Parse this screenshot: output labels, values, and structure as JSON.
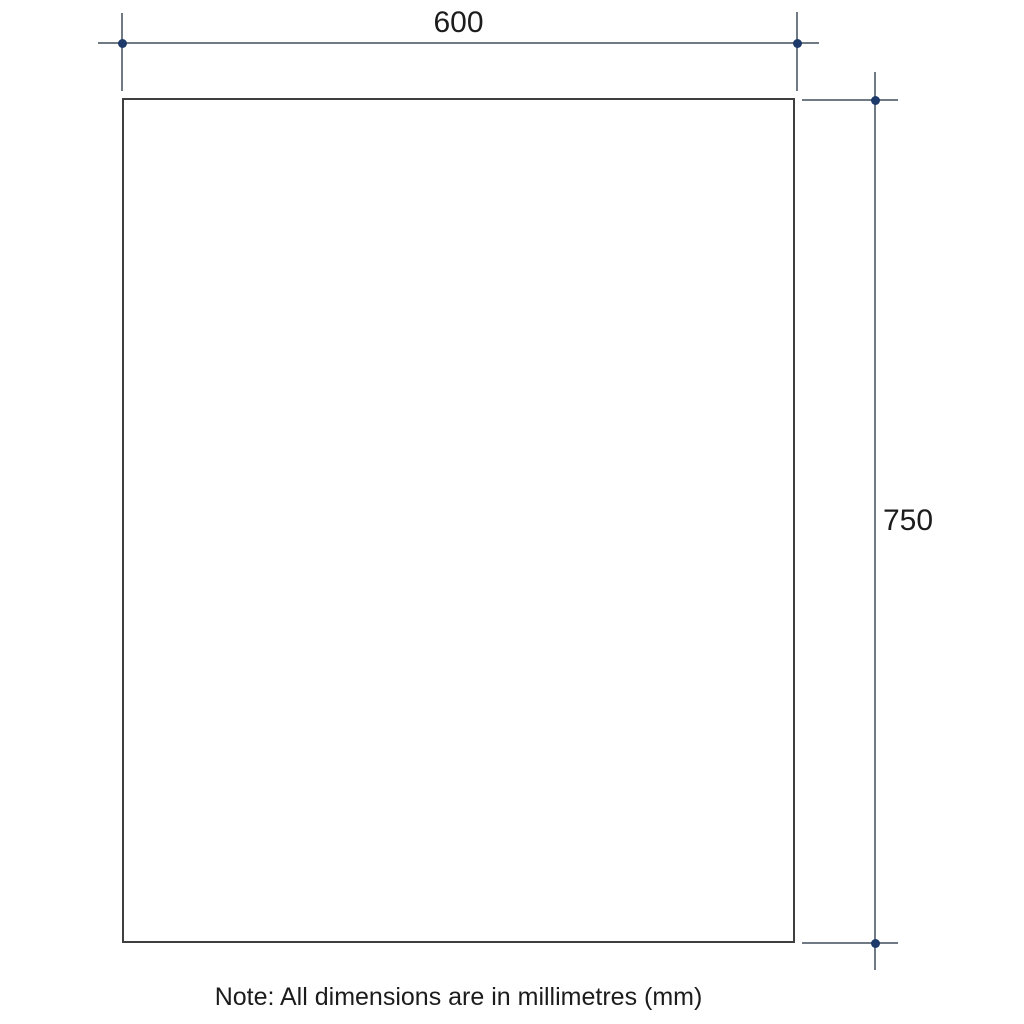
{
  "dimensions": {
    "width": {
      "value": "600"
    },
    "height": {
      "value": "750"
    }
  },
  "note": {
    "text": "Note: All dimensions are in millimetres (mm)"
  },
  "colors": {
    "background": "#ffffff",
    "panel_outline": "#3f3f3f",
    "dimension_line": "#6f7a84",
    "marker_dot": "#1e3a6a",
    "text": "#1c1c1c"
  }
}
